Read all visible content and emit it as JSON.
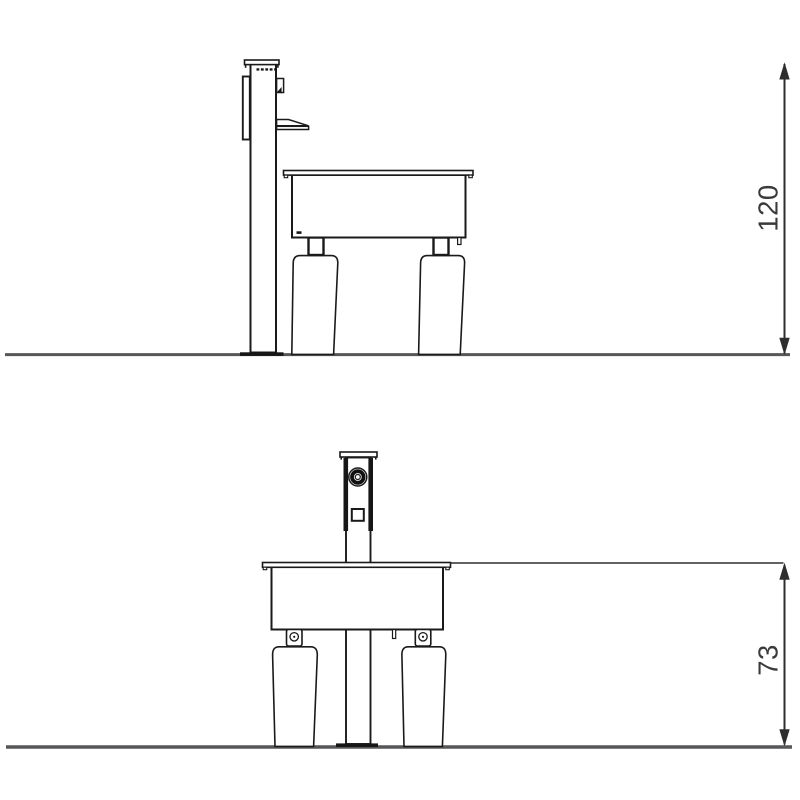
{
  "page": {
    "background": "#ffffff",
    "description_label": "Technical elevation drawing, two views of a post-mounted play table"
  },
  "drawing": {
    "stroke_color": "#1a1a1a",
    "ground_color": "#57575a",
    "dimension_color": "#2e2e2e",
    "views": [
      {
        "name": "side-elevation",
        "dimension_label": "120"
      },
      {
        "name": "front-elevation",
        "dimension_label": "73"
      }
    ]
  }
}
